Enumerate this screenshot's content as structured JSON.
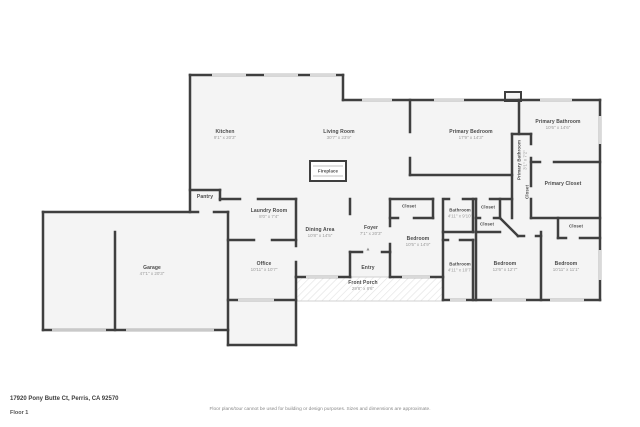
{
  "meta": {
    "address": "17920 Pony Butte Ct, Perris, CA 92570",
    "floor_label": "Floor 1",
    "disclaimer": "Floor plans/tour cannot be used for building or design purposes. Sizes and dimensions are approximate."
  },
  "colors": {
    "wall": "#3f3f3f",
    "room_fill": "#f4f4f4",
    "window": "#d9d9d9",
    "garage_door": "#c9c9c9",
    "room_name": "#4a4a4a",
    "room_dims": "#9a9a9a"
  },
  "rooms": {
    "kitchen": {
      "name": "Kitchen",
      "dims": "9'1\" x 20'3\""
    },
    "living": {
      "name": "Living Room",
      "dims": "30'7\" x 23'9\""
    },
    "primary_bedroom": {
      "name": "Primary Bedroom",
      "dims": "17'9\" x 14'3\""
    },
    "primary_bathroom": {
      "name": "Primary Bathroom",
      "dims": "10'6\" x 14'6\""
    },
    "primary_bathroom_wc": {
      "name": "Primary Bathroom",
      "dims": "3'1\" x 7'2\""
    },
    "primary_closet": {
      "name": "Primary Closet"
    },
    "closet_vertical": {
      "name": "Closet"
    },
    "pantry": {
      "name": "Pantry"
    },
    "laundry": {
      "name": "Laundry Room",
      "dims": "8'0\" x 7'4\""
    },
    "dining": {
      "name": "Dining Area",
      "dims": "10'8\" x 14'5\""
    },
    "foyer": {
      "name": "Foyer",
      "dims": "7'1\" x 20'3\""
    },
    "office": {
      "name": "Office",
      "dims": "10'11\" x 10'7\""
    },
    "garage": {
      "name": "Garage",
      "dims": "47'1\" x 20'3\""
    },
    "entry": {
      "name": "Entry"
    },
    "front_porch": {
      "name": "Front Porch",
      "dims": "29'8\" x 8'6\""
    },
    "bedroom1": {
      "name": "Bedroom",
      "dims": "10'5\" x 14'9\""
    },
    "bedroom2": {
      "name": "Bedroom",
      "dims": "12'6\" x 12'7\""
    },
    "bedroom3": {
      "name": "Bedroom",
      "dims": "10'11\" x 11'1\""
    },
    "bathroom1": {
      "name": "Bathroom",
      "dims": "4'11\" x 9'10\""
    },
    "bathroom2": {
      "name": "Bathroom",
      "dims": "4'11\" x 10'7\""
    },
    "closet1": {
      "name": "Closet"
    },
    "closet2": {
      "name": "Closet"
    },
    "closet3": {
      "name": "Closet"
    },
    "closet4": {
      "name": "Closet"
    },
    "fireplace": {
      "name": "Fireplace"
    }
  }
}
